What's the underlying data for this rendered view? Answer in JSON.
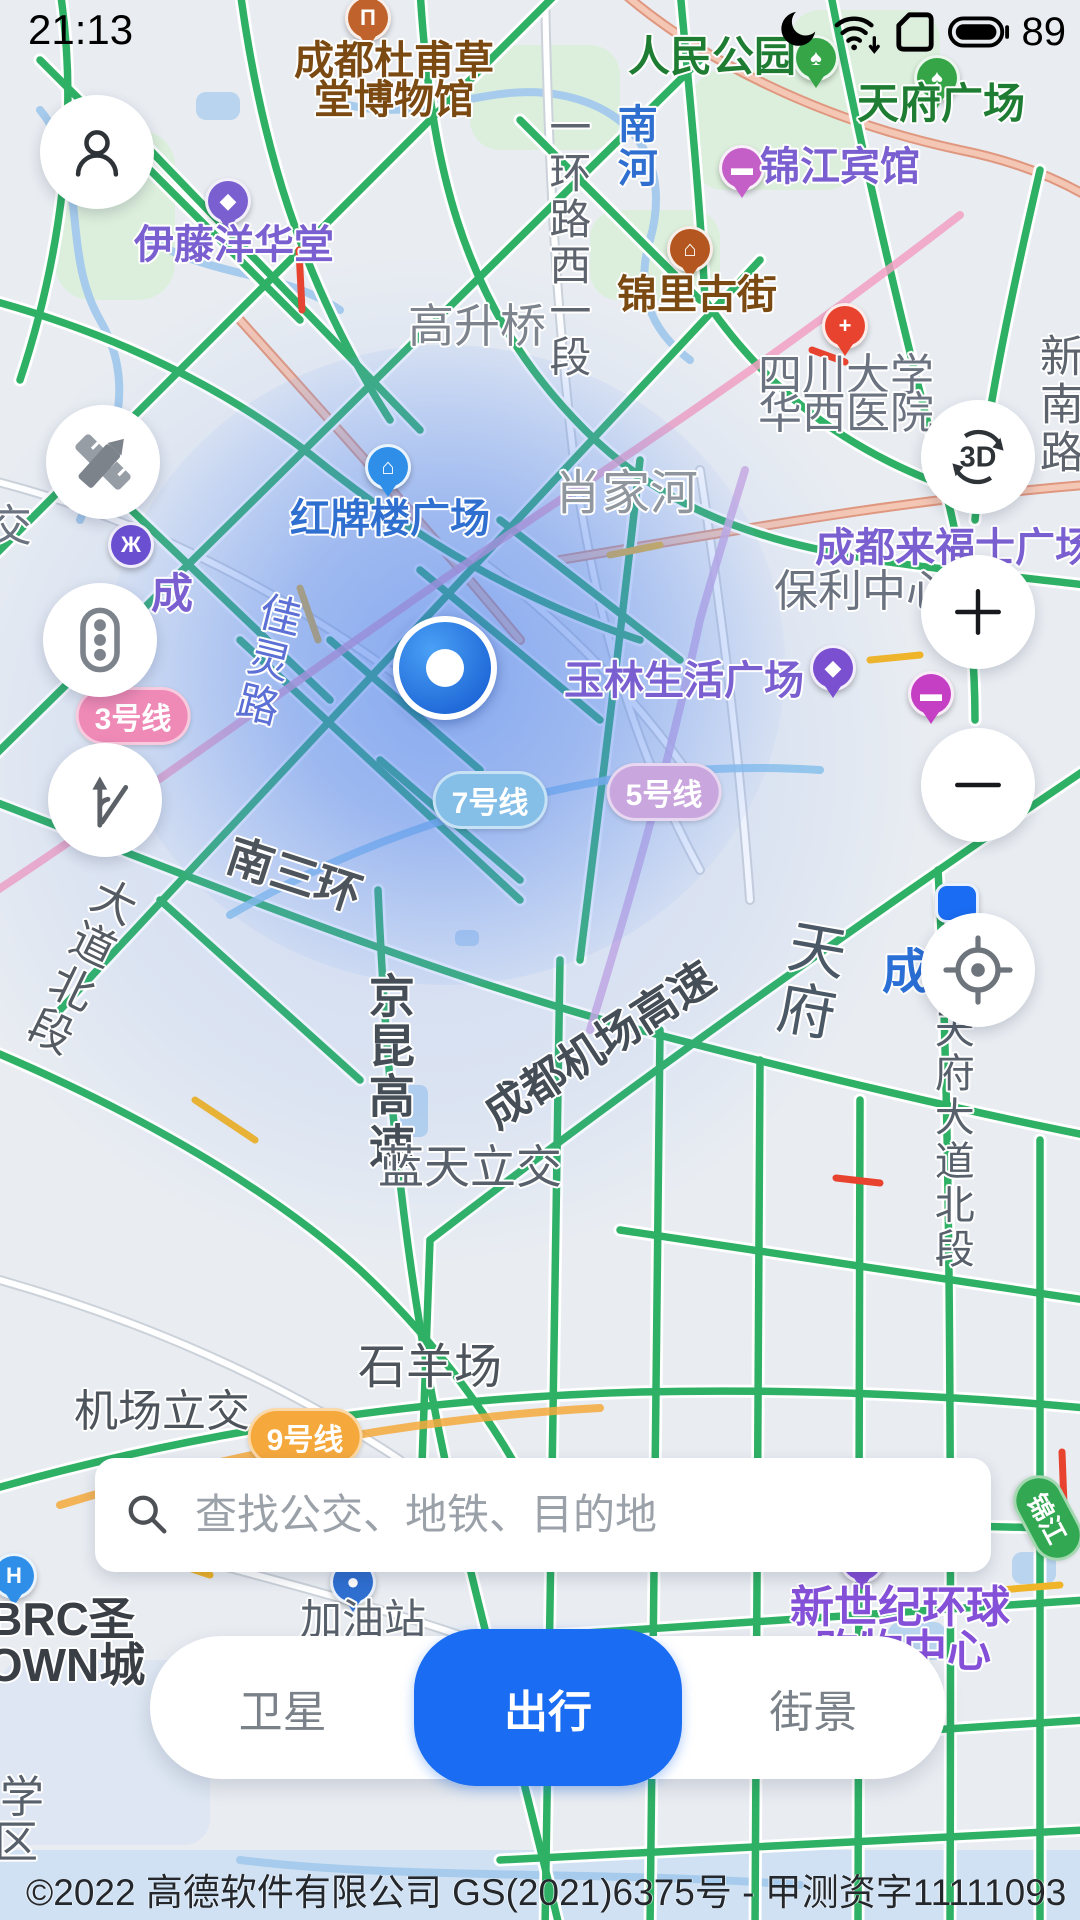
{
  "status_bar": {
    "time": "21:13",
    "battery_percent": "89"
  },
  "controls": {
    "three_d_label": "3D",
    "zoom_in_label": "+",
    "zoom_out_label": "−"
  },
  "search": {
    "placeholder": "查找公交、地铁、目的地"
  },
  "tabs": [
    {
      "label": "卫星",
      "active": false
    },
    {
      "label": "出行",
      "active": true
    },
    {
      "label": "街景",
      "active": false
    }
  ],
  "attribution": "©2022 高德软件有限公司 GS(2021)6375号 - 甲测资字11111093",
  "colors": {
    "accent_blue": "#1a6cf2",
    "road_green": "#2eb165",
    "congestion_yellow": "#f0b429",
    "congestion_red": "#e8432e",
    "water_blue": "#a6cbec"
  },
  "map": {
    "labels": [
      {
        "t": "成都杜甫草",
        "x": 394,
        "y": 62,
        "c": "#7b4a12",
        "s": 40,
        "b": 1
      },
      {
        "t": "堂博物馆",
        "x": 394,
        "y": 101,
        "c": "#7b4a12",
        "s": 40,
        "b": 1
      },
      {
        "t": "人民公园",
        "x": 712,
        "y": 57,
        "c": "#1e7d33",
        "s": 42,
        "b": 1
      },
      {
        "t": "天府广场",
        "x": 941,
        "y": 104,
        "c": "#1e7d33",
        "s": 42,
        "b": 1
      },
      {
        "t": "南河",
        "x": 633,
        "y": 147,
        "c": "#2f6fd0",
        "s": 40,
        "b": 1,
        "v": 1
      },
      {
        "t": "一环路西一段",
        "x": 567,
        "y": 243,
        "c": "#5d646e",
        "s": 42,
        "v": 1
      },
      {
        "t": "锦里古街",
        "x": 697,
        "y": 296,
        "c": "#7b4a12",
        "s": 40,
        "b": 1
      },
      {
        "t": "锦江宾馆",
        "x": 840,
        "y": 168,
        "c": "#7a5fd0",
        "s": 40,
        "b": 1
      },
      {
        "t": "伊藤洋华堂",
        "x": 234,
        "y": 246,
        "c": "#7a5fd0",
        "s": 40,
        "b": 1
      },
      {
        "t": "四川大学",
        "x": 846,
        "y": 376,
        "c": "#6b7280",
        "s": 44
      },
      {
        "t": "华西医院",
        "x": 846,
        "y": 414,
        "c": "#6b7280",
        "s": 44
      },
      {
        "t": "新南路",
        "x": 1057,
        "y": 405,
        "c": "#5d646e",
        "s": 44,
        "v": 1
      },
      {
        "t": "高升桥",
        "x": 477,
        "y": 327,
        "c": "#7d848d",
        "s": 46
      },
      {
        "t": "肖家河",
        "x": 626,
        "y": 494,
        "c": "#8f969e",
        "s": 48
      },
      {
        "t": "红牌楼广场",
        "x": 390,
        "y": 520,
        "c": "#2f6fd0",
        "s": 40,
        "b": 1
      },
      {
        "t": "成都来福士广场",
        "x": 955,
        "y": 549,
        "c": "#7a5fd0",
        "s": 40,
        "b": 1
      },
      {
        "t": "保利中心",
        "x": 862,
        "y": 592,
        "c": "#6b7280",
        "s": 44
      },
      {
        "t": "玉林生活广场",
        "x": 684,
        "y": 682,
        "c": "#7a5fd0",
        "s": 40,
        "b": 1
      },
      {
        "t": "佳灵路",
        "x": 266,
        "y": 660,
        "c": "#5b6fd4",
        "s": 42,
        "v": 1,
        "r": 14
      },
      {
        "t": "交",
        "x": 10,
        "y": 527,
        "c": "#6b7280",
        "s": 44
      },
      {
        "t": "成",
        "x": 172,
        "y": 594,
        "c": "#7a5fd0",
        "s": 42,
        "b": 1
      },
      {
        "t": "南三环",
        "x": 294,
        "y": 876,
        "c": "#4d545c",
        "s": 46,
        "b": 1,
        "r": 18
      },
      {
        "t": "成都机场高速",
        "x": 600,
        "y": 1046,
        "c": "#454d57",
        "s": 44,
        "b": 1,
        "r": -33
      },
      {
        "t": "京昆高速",
        "x": 388,
        "y": 1072,
        "c": "#454d57",
        "s": 46,
        "b": 1,
        "v": 1
      },
      {
        "t": "蓝天立交",
        "x": 470,
        "y": 1168,
        "c": "#57606b",
        "s": 46
      },
      {
        "t": "成",
        "x": 906,
        "y": 973,
        "c": "#2a6fd6",
        "s": 48,
        "b": 1
      },
      {
        "t": "天府大道北段",
        "x": 950,
        "y": 1140,
        "c": "#57606b",
        "s": 40,
        "v": 1
      },
      {
        "t": "天府",
        "x": 806,
        "y": 980,
        "c": "#4b5866",
        "s": 58,
        "v": 1,
        "r": 10
      },
      {
        "t": "石羊场",
        "x": 430,
        "y": 1368,
        "c": "#4d545c",
        "s": 48
      },
      {
        "t": "机场立交",
        "x": 162,
        "y": 1412,
        "c": "#4d545c",
        "s": 44
      },
      {
        "t": "大道北段",
        "x": 78,
        "y": 965,
        "c": "#555b63",
        "s": 44,
        "v": 1,
        "r": 26
      },
      {
        "t": "加油站",
        "x": 363,
        "y": 1620,
        "c": "#57606b",
        "s": 42
      },
      {
        "t": "BRC圣",
        "x": 62,
        "y": 1620,
        "c": "#3a3f45",
        "s": 46,
        "b": 1
      },
      {
        "t": "OWN城",
        "x": 66,
        "y": 1666,
        "c": "#3a3f45",
        "s": 46,
        "b": 1
      },
      {
        "t": "新世纪环球",
        "x": 900,
        "y": 1608,
        "c": "#8450d8",
        "s": 44,
        "b": 1
      },
      {
        "t": "购物中心",
        "x": 903,
        "y": 1652,
        "c": "#8450d8",
        "s": 44,
        "b": 1
      },
      {
        "t": "学",
        "x": 22,
        "y": 1798,
        "c": "#57606b",
        "s": 44
      },
      {
        "t": "区",
        "x": 16,
        "y": 1843,
        "c": "#57606b",
        "s": 44
      }
    ],
    "badges": [
      {
        "t": "3号线",
        "x": 133,
        "y": 716,
        "bg": "#ef8ab6"
      },
      {
        "t": "7号线",
        "x": 490,
        "y": 800,
        "bg": "#85bfe8"
      },
      {
        "t": "5号线",
        "x": 664,
        "y": 792,
        "bg": "#c9a6de"
      },
      {
        "t": "9号线",
        "x": 305,
        "y": 1437,
        "bg": "#f5a93d"
      },
      {
        "t": "S103",
        "x": 240,
        "y": 1487,
        "bg": "#f7cf2e",
        "fg": "#3a3f45",
        "sq": 1
      },
      {
        "t": "锦江",
        "x": 1048,
        "y": 1518,
        "bg": "#33a852",
        "r": 62,
        "fs": 26
      }
    ],
    "pins": [
      {
        "n": "pin-museum",
        "x": 368,
        "y": 18,
        "bg": "#c0622b",
        "g": "Π"
      },
      {
        "n": "pin-park-tree",
        "x": 816,
        "y": 58,
        "bg": "#35a547",
        "g": "♠"
      },
      {
        "n": "pin-square-tree",
        "x": 937,
        "y": 78,
        "bg": "#35a547",
        "g": "♠"
      },
      {
        "n": "pin-hotel",
        "x": 742,
        "y": 168,
        "bg": "#c45fc8",
        "g": "▬"
      },
      {
        "n": "pin-department-store",
        "x": 228,
        "y": 201,
        "bg": "#7a5fd0",
        "g": "◆"
      },
      {
        "n": "pin-old-street",
        "x": 690,
        "y": 249,
        "bg": "#b4561f",
        "g": "⌂"
      },
      {
        "n": "pin-hospital",
        "x": 845,
        "y": 326,
        "bg": "#e8432e",
        "g": "+"
      },
      {
        "n": "pin-plaza",
        "x": 388,
        "y": 467,
        "bg": "#2f8fe8",
        "g": "⌂"
      },
      {
        "n": "pin-metro-logo",
        "x": 131,
        "y": 545,
        "bg": "#6a4fd0",
        "g": "Ж",
        "shape": "circle"
      },
      {
        "n": "pin-shopping",
        "x": 833,
        "y": 668,
        "bg": "#7a4fd0",
        "g": "◆"
      },
      {
        "n": "pin-hotel-bed",
        "x": 931,
        "y": 694,
        "bg": "#c43fc4",
        "g": "▬"
      },
      {
        "n": "pin-station",
        "x": 958,
        "y": 906,
        "bg": "#1a6cf2",
        "g": "",
        "shape": "square"
      },
      {
        "n": "pin-gas-station",
        "x": 353,
        "y": 1582,
        "bg": "#2f6fd0",
        "g": "●"
      },
      {
        "n": "pin-mall",
        "x": 862,
        "y": 1560,
        "bg": "#8450d8",
        "g": "◆"
      },
      {
        "n": "pin-h",
        "x": 14,
        "y": 1576,
        "bg": "#2f8fe8",
        "g": "H"
      }
    ]
  }
}
